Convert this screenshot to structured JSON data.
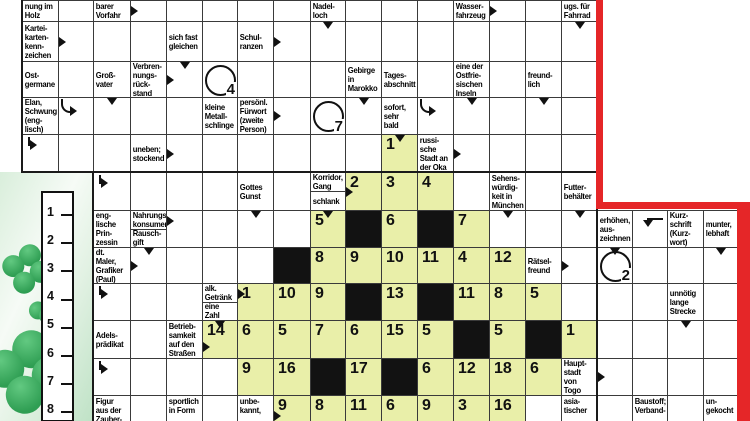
{
  "palette": {
    "green_cell": "#e9efa9",
    "black_cell": "#121212",
    "red_border": "#e52628",
    "grid_line": "#3a3a3a",
    "clover_green": "#2f9e53"
  },
  "solution": {
    "items": [
      "1",
      "2",
      "3",
      "4",
      "5",
      "6",
      "7",
      "8"
    ]
  },
  "grid": {
    "col_x": [
      22,
      58,
      93,
      130,
      166,
      202,
      237,
      273,
      310,
      345,
      381,
      417,
      453,
      489,
      525,
      561,
      597
    ],
    "right_col_x": [
      597,
      632,
      667,
      703,
      737
    ],
    "row_y": [
      0,
      21,
      61,
      97,
      134,
      172,
      210,
      247,
      283,
      320,
      358,
      395,
      421
    ],
    "cells": [
      {
        "r": 0,
        "c": 0,
        "t": "clue",
        "v": "nung im\nHolz"
      },
      {
        "r": 0,
        "c": 1,
        "t": "ans"
      },
      {
        "r": 0,
        "c": 2,
        "t": "clue",
        "v": "nachweis-\nbarer\nVorfahr"
      },
      {
        "r": 0,
        "c": 3,
        "t": "ans",
        "ar": [
          "rm"
        ]
      },
      {
        "r": 0,
        "c": 4,
        "t": "ans"
      },
      {
        "r": 0,
        "c": 5,
        "t": "ans"
      },
      {
        "r": 0,
        "c": 6,
        "t": "ans"
      },
      {
        "r": 0,
        "c": 7,
        "t": "ans"
      },
      {
        "r": 0,
        "c": 8,
        "t": "clue",
        "v": "Nadel-\nloch"
      },
      {
        "r": 0,
        "c": 9,
        "t": "ans"
      },
      {
        "r": 0,
        "c": 10,
        "t": "ans"
      },
      {
        "r": 0,
        "c": 11,
        "t": "ans"
      },
      {
        "r": 0,
        "c": 12,
        "t": "clue",
        "v": "Wasser-\nfahrzeug"
      },
      {
        "r": 0,
        "c": 13,
        "t": "ans",
        "ar": [
          "rm"
        ]
      },
      {
        "r": 0,
        "c": 14,
        "t": "ans"
      },
      {
        "r": 0,
        "c": 15,
        "t": "clue",
        "v": "ugs. für\nFahrrad"
      },
      {
        "r": 1,
        "c": 0,
        "t": "clue",
        "v": "Kartei-\nkarten-\nkenn-\nzeichen"
      },
      {
        "r": 1,
        "c": 1,
        "t": "ans",
        "ar": [
          "rm"
        ]
      },
      {
        "r": 1,
        "c": 2,
        "t": "ans"
      },
      {
        "r": 1,
        "c": 3,
        "t": "ans"
      },
      {
        "r": 1,
        "c": 4,
        "t": "clue",
        "v": "sich fast\ngleichen"
      },
      {
        "r": 1,
        "c": 5,
        "t": "ans"
      },
      {
        "r": 1,
        "c": 6,
        "t": "clue",
        "v": "Schul-\nranzen"
      },
      {
        "r": 1,
        "c": 7,
        "t": "ans",
        "ar": [
          "rm"
        ]
      },
      {
        "r": 1,
        "c": 8,
        "t": "ans",
        "ar": [
          "d"
        ]
      },
      {
        "r": 1,
        "c": 9,
        "t": "ans"
      },
      {
        "r": 1,
        "c": 10,
        "t": "ans"
      },
      {
        "r": 1,
        "c": 11,
        "t": "ans"
      },
      {
        "r": 1,
        "c": 12,
        "t": "ans"
      },
      {
        "r": 1,
        "c": 13,
        "t": "ans"
      },
      {
        "r": 1,
        "c": 14,
        "t": "ans"
      },
      {
        "r": 1,
        "c": 15,
        "t": "ans",
        "ar": [
          "d"
        ]
      },
      {
        "r": 2,
        "c": 0,
        "t": "clue",
        "v": "Ost-\ngermane"
      },
      {
        "r": 2,
        "c": 1,
        "t": "ans"
      },
      {
        "r": 2,
        "c": 2,
        "t": "clue",
        "v": "Groß-\nvater"
      },
      {
        "r": 2,
        "c": 3,
        "t": "clue",
        "v": "Verbren-\nnungs-\nrück-\nstand"
      },
      {
        "r": 2,
        "c": 4,
        "t": "ans",
        "ar": [
          "d",
          "rm"
        ]
      },
      {
        "r": 2,
        "c": 5,
        "t": "cir",
        "v": "4"
      },
      {
        "r": 2,
        "c": 6,
        "t": "ans"
      },
      {
        "r": 2,
        "c": 7,
        "t": "ans"
      },
      {
        "r": 2,
        "c": 8,
        "t": "ans"
      },
      {
        "r": 2,
        "c": 9,
        "t": "clue",
        "v": "Gebirge\nin\nMarokko"
      },
      {
        "r": 2,
        "c": 10,
        "t": "clue",
        "v": "Tages-\nabschnitt"
      },
      {
        "r": 2,
        "c": 11,
        "t": "ans"
      },
      {
        "r": 2,
        "c": 12,
        "t": "clue",
        "v": "eine der\nOstfrie-\nsischen\nInseln"
      },
      {
        "r": 2,
        "c": 13,
        "t": "ans"
      },
      {
        "r": 2,
        "c": 14,
        "t": "clue",
        "v": "freund-\nlich"
      },
      {
        "r": 2,
        "c": 15,
        "t": "ans"
      },
      {
        "r": 3,
        "c": 0,
        "t": "clue",
        "v": "Elan,\nSchwung\n(eng-\nlisch)"
      },
      {
        "r": 3,
        "c": 1,
        "t": "ans",
        "ar": [
          "cv"
        ]
      },
      {
        "r": 3,
        "c": 2,
        "t": "ans",
        "ar": [
          "d"
        ]
      },
      {
        "r": 3,
        "c": 3,
        "t": "ans"
      },
      {
        "r": 3,
        "c": 4,
        "t": "ans"
      },
      {
        "r": 3,
        "c": 5,
        "t": "clue",
        "v": "kleine\nMetall-\nschlinge"
      },
      {
        "r": 3,
        "c": 6,
        "t": "clue",
        "v": "persönl.\nFürwort\n(zweite\nPerson)"
      },
      {
        "r": 3,
        "c": 7,
        "t": "ans",
        "ar": [
          "rm"
        ]
      },
      {
        "r": 3,
        "c": 8,
        "t": "cir",
        "v": "7"
      },
      {
        "r": 3,
        "c": 9,
        "t": "ans",
        "ar": [
          "d"
        ]
      },
      {
        "r": 3,
        "c": 10,
        "t": "clue",
        "v": "sofort,\nsehr\nbald"
      },
      {
        "r": 3,
        "c": 11,
        "t": "ans",
        "ar": [
          "cv"
        ]
      },
      {
        "r": 3,
        "c": 12,
        "t": "ans",
        "ar": [
          "d"
        ]
      },
      {
        "r": 3,
        "c": 13,
        "t": "ans"
      },
      {
        "r": 3,
        "c": 14,
        "t": "ans",
        "ar": [
          "d"
        ]
      },
      {
        "r": 3,
        "c": 15,
        "t": "ans"
      },
      {
        "r": 4,
        "c": 0,
        "t": "ans",
        "ar": [
          "f"
        ]
      },
      {
        "r": 4,
        "c": 1,
        "t": "ans"
      },
      {
        "r": 4,
        "c": 2,
        "t": "ans"
      },
      {
        "r": 4,
        "c": 3,
        "t": "clue",
        "v": "uneben;\nstockend"
      },
      {
        "r": 4,
        "c": 4,
        "t": "ans",
        "ar": [
          "rm"
        ]
      },
      {
        "r": 4,
        "c": 5,
        "t": "ans"
      },
      {
        "r": 4,
        "c": 6,
        "t": "ans"
      },
      {
        "r": 4,
        "c": 7,
        "t": "ans"
      },
      {
        "r": 4,
        "c": 8,
        "t": "ans"
      },
      {
        "r": 4,
        "c": 9,
        "t": "ans"
      },
      {
        "r": 4,
        "c": 10,
        "t": "num",
        "v": "1",
        "ar": [
          "d"
        ]
      },
      {
        "r": 4,
        "c": 11,
        "t": "clue",
        "v": "russi-\nsche\nStadt an\nder Oka"
      },
      {
        "r": 4,
        "c": 12,
        "t": "ans",
        "ar": [
          "rm"
        ]
      },
      {
        "r": 4,
        "c": 13,
        "t": "ans"
      },
      {
        "r": 4,
        "c": 14,
        "t": "ans"
      },
      {
        "r": 4,
        "c": 15,
        "t": "ans"
      },
      {
        "r": 5,
        "c": 2,
        "t": "ans",
        "ar": [
          "f"
        ]
      },
      {
        "r": 5,
        "c": 3,
        "t": "ans"
      },
      {
        "r": 5,
        "c": 4,
        "t": "ans"
      },
      {
        "r": 5,
        "c": 5,
        "t": "ans"
      },
      {
        "r": 5,
        "c": 6,
        "t": "clue",
        "v": "Gottes\nGunst"
      },
      {
        "r": 5,
        "c": 7,
        "t": "ans"
      },
      {
        "r": 5,
        "c": 8,
        "t": "spl",
        "v": "Korridor,\nGang",
        "v2": "schlank"
      },
      {
        "r": 5,
        "c": 9,
        "t": "num",
        "v": "2",
        "ar": [
          "rm"
        ]
      },
      {
        "r": 5,
        "c": 10,
        "t": "num",
        "v": "3"
      },
      {
        "r": 5,
        "c": 11,
        "t": "num",
        "v": "4"
      },
      {
        "r": 5,
        "c": 12,
        "t": "ans"
      },
      {
        "r": 5,
        "c": 13,
        "t": "clue",
        "v": "Sehens-\nwürdig-\nkeit in\nMünchen"
      },
      {
        "r": 5,
        "c": 14,
        "t": "ans"
      },
      {
        "r": 5,
        "c": 15,
        "t": "clue",
        "v": "Futter-\nbehälter"
      },
      {
        "r": 6,
        "c": 2,
        "t": "clue",
        "v": "eng-\nlische\nPrin-\nzessin"
      },
      {
        "r": 6,
        "c": 3,
        "t": "spl",
        "v": "Nahrungs-\nkonsument",
        "v2": "Rausch-\ngift"
      },
      {
        "r": 6,
        "c": 4,
        "t": "ans",
        "ar": [
          "rt"
        ]
      },
      {
        "r": 6,
        "c": 5,
        "t": "ans"
      },
      {
        "r": 6,
        "c": 6,
        "t": "ans",
        "ar": [
          "d"
        ]
      },
      {
        "r": 6,
        "c": 7,
        "t": "ans"
      },
      {
        "r": 6,
        "c": 8,
        "t": "num",
        "v": "5",
        "ar": [
          "d"
        ]
      },
      {
        "r": 6,
        "c": 9,
        "t": "blk"
      },
      {
        "r": 6,
        "c": 10,
        "t": "num",
        "v": "6"
      },
      {
        "r": 6,
        "c": 11,
        "t": "blk"
      },
      {
        "r": 6,
        "c": 12,
        "t": "num",
        "v": "7"
      },
      {
        "r": 6,
        "c": 13,
        "t": "ans",
        "ar": [
          "d"
        ]
      },
      {
        "r": 6,
        "c": 14,
        "t": "ans"
      },
      {
        "r": 6,
        "c": 15,
        "t": "ans",
        "ar": [
          "d"
        ]
      },
      {
        "r": 7,
        "c": 2,
        "t": "clue",
        "v": "dt.\nMaler,\nGrafiker\n(Paul)"
      },
      {
        "r": 7,
        "c": 3,
        "t": "ans",
        "ar": [
          "d",
          "rm"
        ]
      },
      {
        "r": 7,
        "c": 4,
        "t": "ans"
      },
      {
        "r": 7,
        "c": 5,
        "t": "ans"
      },
      {
        "r": 7,
        "c": 6,
        "t": "ans"
      },
      {
        "r": 7,
        "c": 7,
        "t": "blk"
      },
      {
        "r": 7,
        "c": 8,
        "t": "num",
        "v": "8"
      },
      {
        "r": 7,
        "c": 9,
        "t": "num",
        "v": "9"
      },
      {
        "r": 7,
        "c": 10,
        "t": "num",
        "v": "10"
      },
      {
        "r": 7,
        "c": 11,
        "t": "num",
        "v": "11"
      },
      {
        "r": 7,
        "c": 12,
        "t": "num",
        "v": "4"
      },
      {
        "r": 7,
        "c": 13,
        "t": "num",
        "v": "12"
      },
      {
        "r": 7,
        "c": 14,
        "t": "clue",
        "v": "Rätsel-\nfreund"
      },
      {
        "r": 7,
        "c": 15,
        "t": "ans",
        "ar": [
          "rm"
        ]
      },
      {
        "r": 8,
        "c": 2,
        "t": "ans",
        "ar": [
          "f"
        ]
      },
      {
        "r": 8,
        "c": 3,
        "t": "ans"
      },
      {
        "r": 8,
        "c": 4,
        "t": "ans"
      },
      {
        "r": 8,
        "c": 5,
        "t": "spl",
        "v": "alk.\nGetränk",
        "v2": "eine\nZahl"
      },
      {
        "r": 8,
        "c": 6,
        "t": "num",
        "v": "1",
        "ar": [
          "rt"
        ]
      },
      {
        "r": 8,
        "c": 7,
        "t": "num",
        "v": "10"
      },
      {
        "r": 8,
        "c": 8,
        "t": "num",
        "v": "9"
      },
      {
        "r": 8,
        "c": 9,
        "t": "blk"
      },
      {
        "r": 8,
        "c": 10,
        "t": "num",
        "v": "13"
      },
      {
        "r": 8,
        "c": 11,
        "t": "blk"
      },
      {
        "r": 8,
        "c": 12,
        "t": "num",
        "v": "11"
      },
      {
        "r": 8,
        "c": 13,
        "t": "num",
        "v": "8"
      },
      {
        "r": 8,
        "c": 14,
        "t": "num",
        "v": "5"
      },
      {
        "r": 8,
        "c": 15,
        "t": "ans"
      },
      {
        "r": 9,
        "c": 2,
        "t": "clue",
        "v": "Adels-\nprädikat"
      },
      {
        "r": 9,
        "c": 3,
        "t": "ans"
      },
      {
        "r": 9,
        "c": 4,
        "t": "clue",
        "v": "Betrieb-\nsamkeit\nauf den\nStraßen"
      },
      {
        "r": 9,
        "c": 5,
        "t": "num",
        "v": "14",
        "ar": [
          "d",
          "rl"
        ]
      },
      {
        "r": 9,
        "c": 6,
        "t": "num",
        "v": "6"
      },
      {
        "r": 9,
        "c": 7,
        "t": "num",
        "v": "5"
      },
      {
        "r": 9,
        "c": 8,
        "t": "num",
        "v": "7"
      },
      {
        "r": 9,
        "c": 9,
        "t": "num",
        "v": "6"
      },
      {
        "r": 9,
        "c": 10,
        "t": "num",
        "v": "15"
      },
      {
        "r": 9,
        "c": 11,
        "t": "num",
        "v": "5"
      },
      {
        "r": 9,
        "c": 12,
        "t": "blk"
      },
      {
        "r": 9,
        "c": 13,
        "t": "num",
        "v": "5"
      },
      {
        "r": 9,
        "c": 14,
        "t": "blk"
      },
      {
        "r": 9,
        "c": 15,
        "t": "num",
        "v": "1"
      },
      {
        "r": 10,
        "c": 2,
        "t": "ans",
        "ar": [
          "f"
        ]
      },
      {
        "r": 10,
        "c": 3,
        "t": "ans"
      },
      {
        "r": 10,
        "c": 4,
        "t": "ans"
      },
      {
        "r": 10,
        "c": 5,
        "t": "ans"
      },
      {
        "r": 10,
        "c": 6,
        "t": "num",
        "v": "9"
      },
      {
        "r": 10,
        "c": 7,
        "t": "num",
        "v": "16"
      },
      {
        "r": 10,
        "c": 8,
        "t": "blk"
      },
      {
        "r": 10,
        "c": 9,
        "t": "num",
        "v": "17"
      },
      {
        "r": 10,
        "c": 10,
        "t": "blk"
      },
      {
        "r": 10,
        "c": 11,
        "t": "num",
        "v": "6"
      },
      {
        "r": 10,
        "c": 12,
        "t": "num",
        "v": "12"
      },
      {
        "r": 10,
        "c": 13,
        "t": "num",
        "v": "18"
      },
      {
        "r": 10,
        "c": 14,
        "t": "num",
        "v": "6"
      },
      {
        "r": 10,
        "c": 15,
        "t": "clue",
        "v": "Haupt-\nstadt\nvon Togo"
      },
      {
        "r": 11,
        "c": 2,
        "t": "clue",
        "v": "Figur\naus der\nZauber-"
      },
      {
        "r": 11,
        "c": 3,
        "t": "ans"
      },
      {
        "r": 11,
        "c": 4,
        "t": "clue",
        "v": "sportlich\nin Form"
      },
      {
        "r": 11,
        "c": 5,
        "t": "ans"
      },
      {
        "r": 11,
        "c": 6,
        "t": "clue",
        "v": "unbe-\nkannt,"
      },
      {
        "r": 11,
        "c": 7,
        "t": "num",
        "v": "9",
        "ar": [
          "rl"
        ]
      },
      {
        "r": 11,
        "c": 8,
        "t": "num",
        "v": "8"
      },
      {
        "r": 11,
        "c": 9,
        "t": "num",
        "v": "11"
      },
      {
        "r": 11,
        "c": 10,
        "t": "num",
        "v": "6"
      },
      {
        "r": 11,
        "c": 11,
        "t": "num",
        "v": "9"
      },
      {
        "r": 11,
        "c": 12,
        "t": "num",
        "v": "3"
      },
      {
        "r": 11,
        "c": 13,
        "t": "num",
        "v": "16"
      },
      {
        "r": 11,
        "c": 14,
        "t": "ans"
      },
      {
        "r": 11,
        "c": 15,
        "t": "clue",
        "v": "asia-\ntischer"
      },
      {
        "r": 6,
        "c": 0,
        "R": 1,
        "t": "clue",
        "v": "erhöhen,\naus-\nzeichnen"
      },
      {
        "r": 6,
        "c": 1,
        "R": 1,
        "t": "ans",
        "ar": [
          "bd"
        ]
      },
      {
        "r": 6,
        "c": 2,
        "R": 1,
        "t": "clue",
        "v": "Kurz-\nschrift\n(Kurz-\nwort)"
      },
      {
        "r": 6,
        "c": 3,
        "R": 1,
        "t": "clue",
        "v": "munter,\nlebhaft"
      },
      {
        "r": 7,
        "c": 0,
        "R": 1,
        "t": "cir",
        "v": "2",
        "ar": [
          "d"
        ]
      },
      {
        "r": 7,
        "c": 1,
        "R": 1,
        "t": "ans"
      },
      {
        "r": 7,
        "c": 2,
        "R": 1,
        "t": "ans"
      },
      {
        "r": 7,
        "c": 3,
        "R": 1,
        "t": "ans",
        "ar": [
          "d"
        ]
      },
      {
        "r": 8,
        "c": 0,
        "R": 1,
        "t": "ans"
      },
      {
        "r": 8,
        "c": 1,
        "R": 1,
        "t": "ans"
      },
      {
        "r": 8,
        "c": 2,
        "R": 1,
        "t": "clue",
        "v": "unnötig\nlange\nStrecke"
      },
      {
        "r": 8,
        "c": 3,
        "R": 1,
        "t": "ans"
      },
      {
        "r": 9,
        "c": 0,
        "R": 1,
        "t": "ans"
      },
      {
        "r": 9,
        "c": 1,
        "R": 1,
        "t": "ans"
      },
      {
        "r": 9,
        "c": 2,
        "R": 1,
        "t": "ans",
        "ar": [
          "d"
        ]
      },
      {
        "r": 9,
        "c": 3,
        "R": 1,
        "t": "ans"
      },
      {
        "r": 10,
        "c": 0,
        "R": 1,
        "t": "ans",
        "ar": [
          "rm"
        ]
      },
      {
        "r": 10,
        "c": 1,
        "R": 1,
        "t": "ans"
      },
      {
        "r": 10,
        "c": 2,
        "R": 1,
        "t": "ans"
      },
      {
        "r": 10,
        "c": 3,
        "R": 1,
        "t": "ans"
      },
      {
        "r": 11,
        "c": 0,
        "R": 1,
        "t": "ans"
      },
      {
        "r": 11,
        "c": 1,
        "R": 1,
        "t": "clue",
        "v": "Baustoff;\nVerband-"
      },
      {
        "r": 11,
        "c": 2,
        "R": 1,
        "t": "ans"
      },
      {
        "r": 11,
        "c": 3,
        "R": 1,
        "t": "clue",
        "v": "un-\ngekocht"
      }
    ]
  }
}
